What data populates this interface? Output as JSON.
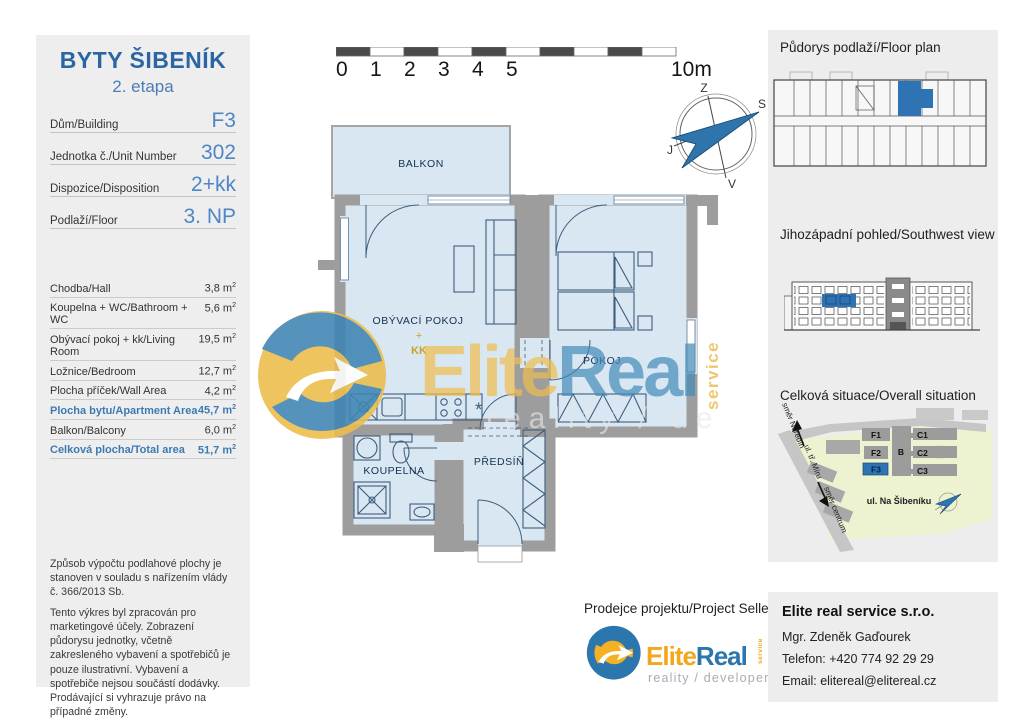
{
  "left_panel": {
    "title": "BYTY ŠIBENÍK",
    "subtitle": "2. etapa",
    "info_rows": [
      {
        "label": "Dům/Building",
        "value": "F3"
      },
      {
        "label": "Jednotka č./Unit Number",
        "value": "302"
      },
      {
        "label": "Dispozice/Disposition",
        "value": "2+kk"
      },
      {
        "label": "Podlaží/Floor",
        "value": "3. NP"
      }
    ],
    "area_unit": "m",
    "area_sup": "2",
    "area_rows": [
      {
        "label": "Chodba/Hall",
        "value": "3,8",
        "highlight": false
      },
      {
        "label": "Koupelna + WC/Bathroom + WC",
        "value": "5,6",
        "highlight": false
      },
      {
        "label": "Obývací pokoj + kk/Living Room",
        "value": "19,5",
        "highlight": false
      },
      {
        "label": "Ložnice/Bedroom",
        "value": "12,7",
        "highlight": false
      },
      {
        "label": "Plocha příček/Wall Area",
        "value": "4,2",
        "highlight": false
      },
      {
        "label": "Plocha bytu/Apartment Area",
        "value": "45,7",
        "highlight": true
      },
      {
        "label": "Balkon/Balcony",
        "value": "6,0",
        "highlight": false
      },
      {
        "label": "Celková plocha/Total area",
        "value": "51,7",
        "highlight": true
      }
    ],
    "legal": [
      "Způsob výpočtu podlahové plochy je stanoven v souladu s nařízením vlády č. 366/2013 Sb.",
      "Tento výkres byl zpracován pro marketingové účely. Zobrazení půdorysu jednotky, včetně zakresleného vybavení a spotřebičů je pouze ilustrativní. Vybavení a spotřebiče nejsou součástí dodávky. Prodávající si vyhrazuje právo na případné změny."
    ]
  },
  "plan": {
    "scale_labels": [
      "0",
      "1",
      "2",
      "3",
      "4",
      "5"
    ],
    "scale_end": "10m",
    "compass": {
      "top": "Z",
      "right": "S",
      "left": "J",
      "bottom": "V"
    },
    "rooms": {
      "balcony": "BALKON",
      "living": "OBÝVACÍ POKOJ",
      "living_plus": "+",
      "living_kk": "KK",
      "bedroom": "POKOJ",
      "bathroom": "KOUPELNA",
      "hall": "PŘEDSÍŇ"
    }
  },
  "watermark": {
    "brand_a": "Elite",
    "brand_b": "Real",
    "vertical": "service",
    "tagline": "reality / de"
  },
  "right_panel": {
    "floorplan_title": "Půdorys podlaží/Floor plan",
    "elevation_title": "Jihozápadní pohled/Southwest view",
    "situation_title": "Celková situace/Overall situation",
    "blocks": {
      "f1": "F1",
      "f2": "F2",
      "f3": "F3",
      "b": "B",
      "c1": "C1",
      "c2": "C2",
      "c3": "C3"
    },
    "streets": {
      "neredin": "směr Neředín",
      "miru": "ul. tř. Míru",
      "centrum": "směr centrum",
      "sibeniku": "ul. Na Šibeníku"
    }
  },
  "footer": {
    "seller_label": "Prodejce projektu/Project Seller",
    "brand_a": "Elite",
    "brand_b": "Real",
    "brand_vertical": "service",
    "brand_tagline": "reality / developer",
    "company": "Elite real service s.r.o.",
    "person": "Mgr. Zdeněk Gaďourek",
    "phone": "Telefon: +420 774 92 29 29",
    "email": "Email: elitereal@elitereal.cz"
  },
  "colors": {
    "accent_blue": "#2e73b4",
    "value_blue": "#4e86c6",
    "brand_yellow": "#f2b01e",
    "wall_gray": "#9d9d9d",
    "room_fill": "#d9e7f3"
  }
}
